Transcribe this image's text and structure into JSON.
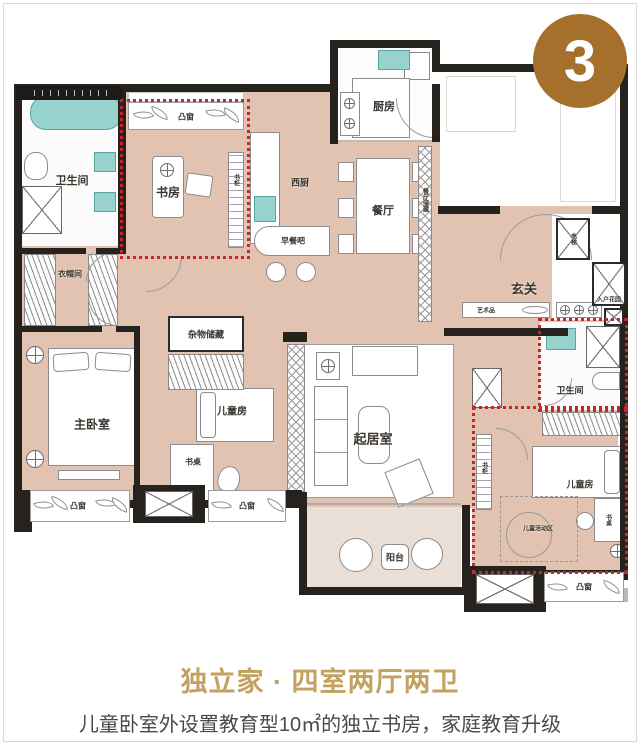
{
  "badge": {
    "number": "3"
  },
  "plan": {
    "labels": {
      "bath": "卫生间",
      "study": "书房",
      "bay_window": "凸窗",
      "west_kitchen": "西厨",
      "kitchen": "厨房",
      "dining": "餐厅",
      "breakfast_bar": "早餐吧",
      "dining_storage": "餐厅储藏",
      "foyer": "玄关",
      "elevator": "电梯",
      "entry_garden": "入户花园",
      "artwork": "艺术品",
      "cloakroom": "衣帽间",
      "master_bedroom": "主卧室",
      "storage": "杂物储藏",
      "kids_room": "儿童房",
      "desk": "书桌",
      "bookshelf": "书柜",
      "living_room": "起居室",
      "kids_activity": "儿童活动区",
      "balcony": "阳台"
    }
  },
  "footer": {
    "title": "独立家 · 四室两厅两卫",
    "subtitle": "儿童卧室外设置教育型10㎡的独立书房，家庭教育升级"
  },
  "colors": {
    "badge_gold": "#a5702b",
    "title_gold": "#c2a161",
    "subtitle_gray": "#4a4a4a",
    "wall_black": "#26221d",
    "floor_tan": "#e2c3b1",
    "fixture_teal": "#97d2cf",
    "highlight_red": "#c4282d"
  }
}
